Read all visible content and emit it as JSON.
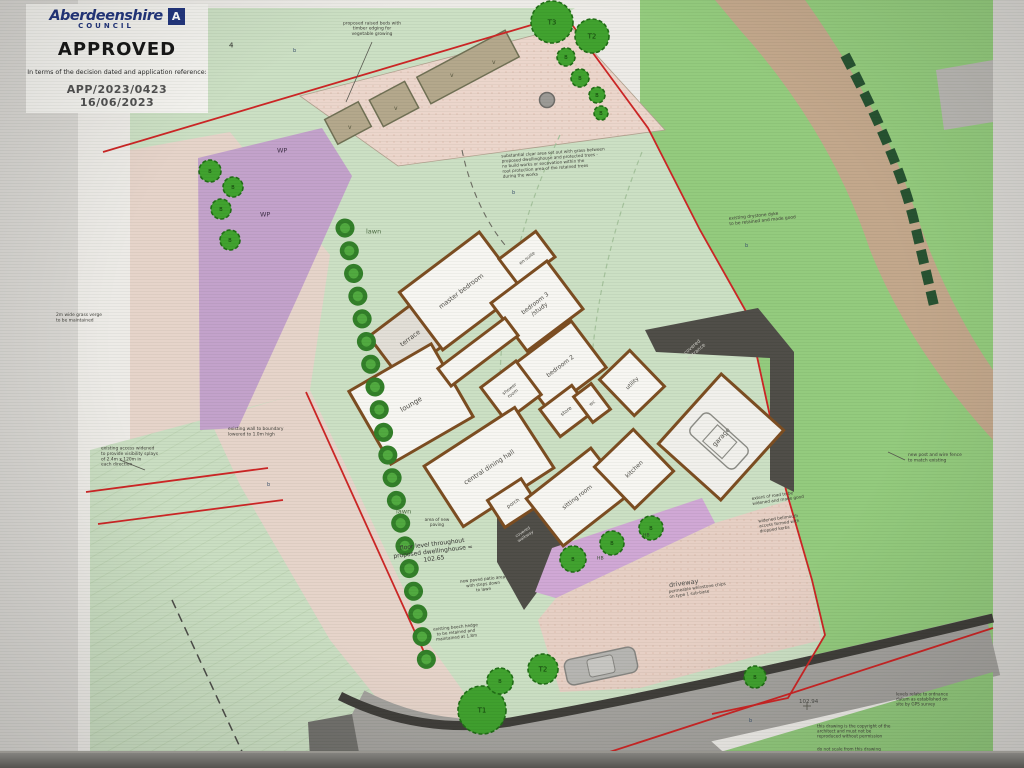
{
  "stamp": {
    "council_name": "Aberdeenshire",
    "council_sub": "COUNCIL",
    "logo_letter": "A",
    "status": "APPROVED",
    "statement": "In terms of the decision dated and application reference:",
    "app_ref": "APP/2023/0423",
    "decision_date": "16/06/2023"
  },
  "colors": {
    "boundary_red": "#cc2222",
    "grass_pale": "#cbdfc3",
    "grass_bright": "#92ca7b",
    "pink": "#e7cfc4",
    "purple_wp": "#c2a0ca",
    "purple_bed": "#cfa6d4",
    "tan_road": "#c2a68a",
    "road_gray": "#a3a19d",
    "dark_structure": "#4c4a45",
    "wall": "#7a4a1e",
    "room_fill": "#f7f6f2",
    "tree_fill": "#3da02b",
    "tree_stroke": "#1d6b12",
    "stamp_navy": "#20337c",
    "note_ink": "#3c3c36"
  },
  "plan": {
    "rooms": [
      {
        "id": "terrace",
        "lines": [
          "terrace"
        ],
        "cx": 410,
        "cy": 338,
        "w": 64,
        "h": 52,
        "angle": -37,
        "fs": 6.5,
        "fill": "#e2ded6"
      },
      {
        "id": "lounge",
        "lines": [
          "lounge"
        ],
        "cx": 411,
        "cy": 404,
        "w": 95,
        "h": 84,
        "angle": -30,
        "fs": 7
      },
      {
        "id": "master-bedroom",
        "lines": [
          "master bedroom"
        ],
        "cx": 461,
        "cy": 291,
        "w": 100,
        "h": 72,
        "angle": -37,
        "fs": 6.5
      },
      {
        "id": "en-suite",
        "lines": [
          "en-suite"
        ],
        "cx": 527,
        "cy": 258,
        "w": 46,
        "h": 32,
        "angle": -37,
        "fs": 4.6
      },
      {
        "id": "bedroom-3",
        "lines": [
          "bedroom 3",
          "/study"
        ],
        "cx": 537,
        "cy": 306,
        "w": 70,
        "h": 60,
        "angle": -37,
        "fs": 6
      },
      {
        "id": "hall",
        "lines": [],
        "cx": 478,
        "cy": 352,
        "w": 84,
        "h": 22,
        "angle": -37,
        "fs": 5
      },
      {
        "id": "bedroom-2",
        "lines": [
          "bedroom 2"
        ],
        "cx": 560,
        "cy": 366,
        "w": 72,
        "h": 58,
        "angle": -37,
        "fs": 6
      },
      {
        "id": "shower-room",
        "lines": [
          "shower",
          "room"
        ],
        "cx": 511,
        "cy": 391,
        "w": 44,
        "h": 42,
        "angle": -37,
        "fs": 4.6
      },
      {
        "id": "store",
        "lines": [
          "store"
        ],
        "cx": 566,
        "cy": 411,
        "w": 40,
        "h": 34,
        "angle": -37,
        "fs": 5
      },
      {
        "id": "wc",
        "lines": [
          "wc"
        ],
        "cx": 592,
        "cy": 403,
        "w": 22,
        "h": 32,
        "angle": -37,
        "fs": 4.6
      },
      {
        "id": "utility",
        "lines": [
          "utility"
        ],
        "cx": 632,
        "cy": 383,
        "w": 42,
        "h": 50,
        "angle": -44,
        "fs": 5.5
      },
      {
        "id": "central-dining-hall",
        "lines": [
          "central dining hall"
        ],
        "cx": 489,
        "cy": 467,
        "w": 108,
        "h": 72,
        "angle": -33,
        "fs": 6.5
      },
      {
        "id": "porch",
        "lines": [
          "porch"
        ],
        "cx": 513,
        "cy": 503,
        "w": 40,
        "h": 32,
        "angle": -33,
        "fs": 5
      },
      {
        "id": "sitting-room",
        "lines": [
          "sitting room"
        ],
        "cx": 577,
        "cy": 497,
        "w": 82,
        "h": 60,
        "angle": -38,
        "fs": 6
      },
      {
        "id": "kitchen",
        "lines": [
          "kitchen"
        ],
        "cx": 634,
        "cy": 469,
        "w": 54,
        "h": 58,
        "angle": -44,
        "fs": 6
      },
      {
        "id": "garage",
        "lines": [
          "garage"
        ],
        "cx": 721,
        "cy": 437,
        "w": 94,
        "h": 84,
        "angle": -48,
        "fs": 6.5,
        "fill": "#f1f0ec"
      }
    ],
    "trees": [
      {
        "x": 552,
        "y": 22,
        "r": 21,
        "label": "T3"
      },
      {
        "x": 592,
        "y": 36,
        "r": 17,
        "label": "T2"
      },
      {
        "x": 566,
        "y": 57,
        "r": 9,
        "label": "B"
      },
      {
        "x": 580,
        "y": 78,
        "r": 9,
        "label": "B"
      },
      {
        "x": 597,
        "y": 95,
        "r": 8,
        "label": "B"
      },
      {
        "x": 601,
        "y": 113,
        "r": 7,
        "label": "B"
      },
      {
        "x": 210,
        "y": 171,
        "r": 11,
        "label": "B"
      },
      {
        "x": 233,
        "y": 187,
        "r": 10,
        "label": "B"
      },
      {
        "x": 221,
        "y": 209,
        "r": 10,
        "label": "B"
      },
      {
        "x": 230,
        "y": 240,
        "r": 10,
        "label": "B"
      },
      {
        "x": 482,
        "y": 710,
        "r": 24,
        "label": "T1"
      },
      {
        "x": 500,
        "y": 681,
        "r": 13,
        "label": "B"
      },
      {
        "x": 543,
        "y": 669,
        "r": 15,
        "label": "T2"
      },
      {
        "x": 755,
        "y": 677,
        "r": 11,
        "label": "B"
      },
      {
        "x": 573,
        "y": 559,
        "r": 13,
        "label": "B"
      },
      {
        "x": 612,
        "y": 543,
        "r": 12,
        "label": "B"
      },
      {
        "x": 651,
        "y": 528,
        "r": 12,
        "label": "B"
      }
    ],
    "annotations": [
      {
        "id": "note-raised-beds",
        "x": 372,
        "y": 28,
        "fs": 4.4,
        "anchor": "middle",
        "lines": [
          "proposed raised beds with",
          "timber edging for",
          "vegetable growing"
        ]
      },
      {
        "id": "note-tree-protection",
        "x": 502,
        "y": 166,
        "fs": 4.2,
        "angle": -4,
        "lines": [
          "substantial clear area set out with grass between",
          "proposed dwellinghouse and protected trees -",
          "no build works or excavation within the",
          "root protection area of the retained trees",
          "during the works"
        ]
      },
      {
        "id": "note-drystone-dyke",
        "x": 729,
        "y": 221,
        "fs": 4.4,
        "angle": -6,
        "lines": [
          "existing drystone dyke",
          "to be retained and made good"
        ]
      },
      {
        "id": "note-grass-verge",
        "x": 56,
        "y": 317,
        "fs": 4.4,
        "lines": [
          "2m wide grass verge",
          "to be maintained"
        ]
      },
      {
        "id": "note-access",
        "x": 101,
        "y": 456,
        "fs": 4.4,
        "lines": [
          "existing access widened",
          "to provide visibility splays",
          "of 2.4m x 120m in",
          "each direction"
        ]
      },
      {
        "id": "note-boundary-wall",
        "x": 228,
        "y": 431,
        "fs": 4.4,
        "lines": [
          "existing wall to boundary",
          "lowered to 1.0m high"
        ]
      },
      {
        "id": "note-floor-level",
        "x": 433,
        "y": 551,
        "fs": 6,
        "anchor": "middle",
        "angle": -7,
        "color": "#333330",
        "lines": [
          "floor level throughout",
          "proposed dwellinghouse =",
          "102.65"
        ]
      },
      {
        "id": "note-paving",
        "x": 437,
        "y": 522,
        "fs": 4.2,
        "anchor": "middle",
        "lines": [
          "area of new",
          "paving"
        ]
      },
      {
        "id": "label-covered-walkway",
        "x": 524,
        "y": 534,
        "fs": 4.2,
        "anchor": "middle",
        "angle": -33,
        "color": "#d6d4cf",
        "lines": [
          "covered",
          "walkway"
        ]
      },
      {
        "id": "label-covered-entrance",
        "x": 694,
        "y": 349,
        "fs": 5,
        "anchor": "middle",
        "angle": -41,
        "color": "#cfcdc6",
        "lines": [
          "covered",
          "entrance"
        ]
      },
      {
        "id": "note-patio",
        "x": 483,
        "y": 584,
        "fs": 4.2,
        "anchor": "middle",
        "angle": -6,
        "lines": [
          "new paved patio area",
          "with steps down",
          "to lawn"
        ]
      },
      {
        "id": "note-beech-hedge",
        "x": 456,
        "y": 632,
        "fs": 4.2,
        "anchor": "middle",
        "angle": -6,
        "lines": [
          "existing beech hedge",
          "to be retained and",
          "maintained at 1.8m"
        ]
      },
      {
        "id": "label-driveway",
        "x": 669,
        "y": 585,
        "fs": 6.5,
        "angle": -8,
        "color": "#4a4a46",
        "lines": [
          "driveway"
        ]
      },
      {
        "id": "note-driveway-finish",
        "x": 669,
        "y": 594,
        "fs": 4.2,
        "angle": -8,
        "lines": [
          "permeable whinstone chips",
          "on type 1 sub-base"
        ]
      },
      {
        "id": "note-road-widened",
        "x": 752,
        "y": 501,
        "fs": 4.2,
        "angle": -8,
        "lines": [
          "extent of road to be",
          "widened and made good"
        ]
      },
      {
        "id": "note-bellmouth",
        "x": 759,
        "y": 526,
        "fs": 4.2,
        "angle": -8,
        "lines": [
          "widened bellmouth",
          "access formed with",
          "dropped kerbs"
        ]
      },
      {
        "id": "note-fence",
        "x": 908,
        "y": 457,
        "fs": 4.4,
        "lines": [
          "new post and wire fence",
          "to match existing"
        ]
      },
      {
        "id": "spot-level-102-94",
        "x": 799,
        "y": 701,
        "fs": 5.5,
        "color": "#4a4a46",
        "lines": [
          "102.94"
        ]
      },
      {
        "id": "note-levels-datum",
        "x": 896,
        "y": 699,
        "fs": 4.2,
        "lines": [
          "levels relate to ordnance",
          "datum as established on",
          "site by GPS survey"
        ]
      },
      {
        "id": "note-copyright",
        "x": 817,
        "y": 731,
        "fs": 4.2,
        "lines": [
          "this drawing is the copyright of the",
          "architect and must not be",
          "reproduced without permission"
        ]
      },
      {
        "id": "note-do-not-scale",
        "x": 817,
        "y": 749,
        "fs": 4.2,
        "lines": [
          "do not scale from this drawing"
        ]
      },
      {
        "id": "label-lawn-1",
        "x": 366,
        "y": 231,
        "fs": 6.5,
        "color": "#4c6b42",
        "lines": [
          "lawn"
        ]
      },
      {
        "id": "label-lawn-2",
        "x": 396,
        "y": 511,
        "fs": 6.5,
        "color": "#4c6b42",
        "lines": [
          "lawn"
        ]
      },
      {
        "id": "label-wp-1",
        "x": 277,
        "y": 150,
        "fs": 6.5,
        "color": "#3d2e46",
        "lines": [
          "WP"
        ]
      },
      {
        "id": "label-wp-2",
        "x": 260,
        "y": 214,
        "fs": 6.5,
        "color": "#3d2e46",
        "lines": [
          "WP"
        ]
      },
      {
        "id": "label-hb-1",
        "x": 597,
        "y": 558,
        "fs": 4.6,
        "color": "#2e4427",
        "lines": [
          "HB"
        ]
      },
      {
        "id": "label-hb-2",
        "x": 643,
        "y": 535,
        "fs": 4.6,
        "color": "#2e4427",
        "lines": [
          "HB"
        ]
      },
      {
        "id": "label-tree-ref-4",
        "x": 229,
        "y": 45,
        "fs": 7,
        "color": "#2b2b28",
        "lines": [
          "4"
        ]
      },
      {
        "id": "marker-b-1",
        "x": 293,
        "y": 50,
        "fs": 5,
        "color": "#39506b",
        "lines": [
          "b"
        ]
      },
      {
        "id": "marker-b-2",
        "x": 512,
        "y": 192,
        "fs": 5,
        "color": "#39506b",
        "lines": [
          "b"
        ]
      },
      {
        "id": "marker-b-3",
        "x": 745,
        "y": 245,
        "fs": 5,
        "color": "#39506b",
        "lines": [
          "b"
        ]
      },
      {
        "id": "marker-b-4",
        "x": 267,
        "y": 484,
        "fs": 5,
        "color": "#39506b",
        "lines": [
          "b"
        ]
      },
      {
        "id": "marker-b-5",
        "x": 749,
        "y": 720,
        "fs": 5,
        "color": "#39506b",
        "lines": [
          "b"
        ]
      },
      {
        "id": "bed-plant-mark-1",
        "x": 348,
        "y": 127,
        "fs": 6,
        "color": "#55543c",
        "lines": [
          "v"
        ]
      },
      {
        "id": "bed-plant-mark-2",
        "x": 394,
        "y": 108,
        "fs": 6,
        "color": "#55543c",
        "lines": [
          "v"
        ]
      },
      {
        "id": "bed-plant-mark-3",
        "x": 450,
        "y": 75,
        "fs": 6,
        "color": "#55543c",
        "lines": [
          "v"
        ]
      },
      {
        "id": "bed-plant-mark-4",
        "x": 492,
        "y": 62,
        "fs": 6,
        "color": "#55543c",
        "lines": [
          "v"
        ]
      }
    ]
  }
}
